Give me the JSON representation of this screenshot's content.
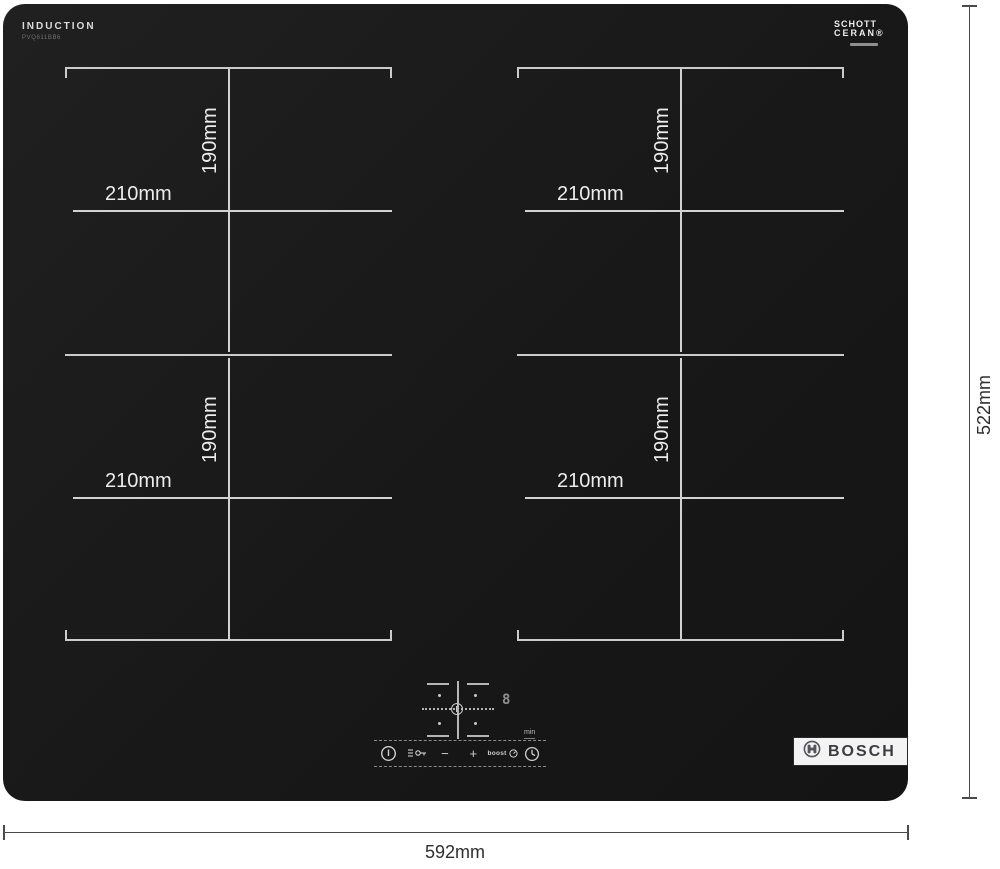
{
  "surface": {
    "title": "INDUCTION",
    "model": "PVQ611BB6",
    "glass_brand": {
      "line1": "SCHOTT",
      "line2": "CERAN®"
    }
  },
  "zones": [
    {
      "position": "back-left",
      "width": "210mm",
      "height": "190mm"
    },
    {
      "position": "front-left",
      "width": "210mm",
      "height": "190mm"
    },
    {
      "position": "back-right",
      "width": "210mm",
      "height": "190mm"
    },
    {
      "position": "front-right",
      "width": "210mm",
      "height": "190mm"
    }
  ],
  "control_panel": {
    "power_display": "8",
    "min_label": "min",
    "buttons": {
      "minus": "−",
      "plus": "+",
      "boost": "boost"
    }
  },
  "brand_logo": "BOSCH",
  "dimensions": {
    "width": "592mm",
    "height": "522mm"
  },
  "colors": {
    "glass": "#1b1b1b",
    "marking": "#d2d2d2",
    "dimension_line": "#4a4a4a"
  }
}
